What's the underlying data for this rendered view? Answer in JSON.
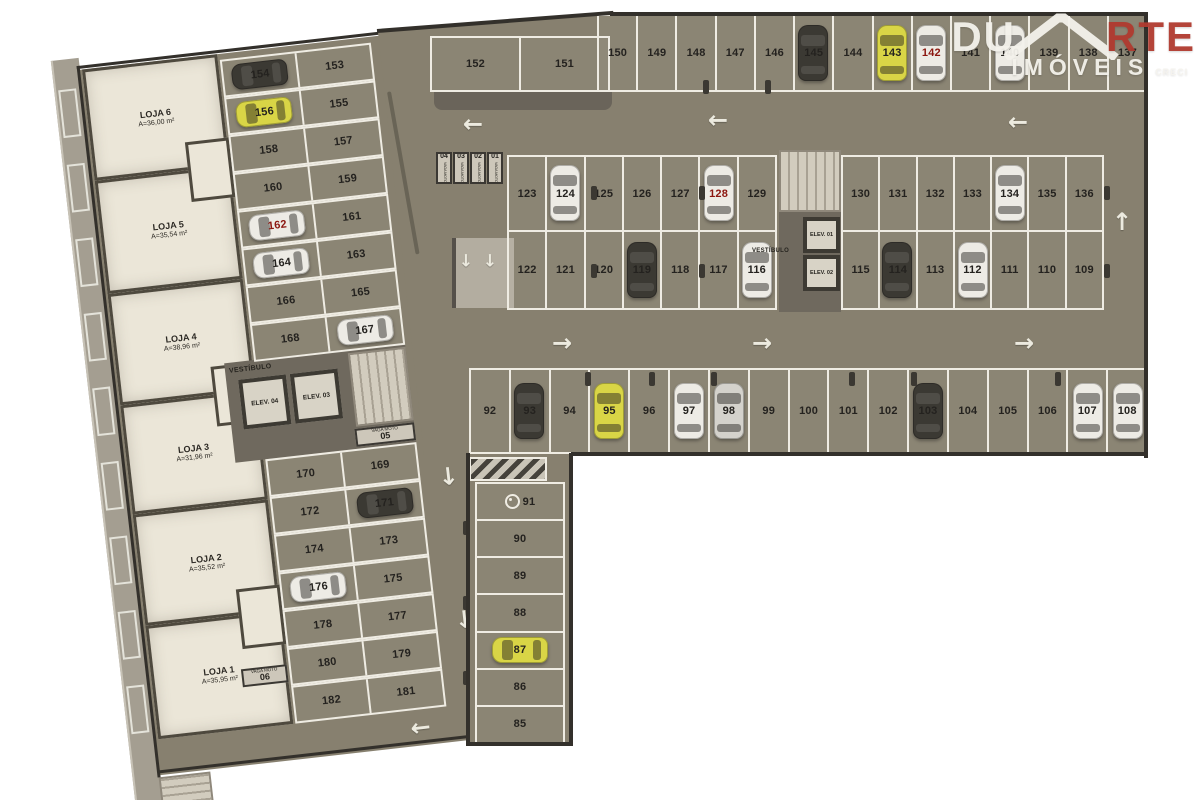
{
  "watermark": {
    "du": "DU",
    "rte": "RTE",
    "imoveis": "IMÓVEIS",
    "creci": "CRECI"
  },
  "colors": {
    "floor": "#87806F",
    "spot_line": "#EFECE3",
    "wall": "#33302B",
    "loja_fill": "#EBE6D8",
    "sidewalk": "#A49E91",
    "ramp": "#B3ADA0",
    "stairs": "#CFC9BB",
    "corridor": "#6F695E",
    "elev_face": "#D8D3C6",
    "accent_red": "#8C1710",
    "logo_red": "#B03A2F",
    "car_dark": "#34312B",
    "car_light": "#EDEBE4",
    "car_yellow": "#D8D43F",
    "car_silver": "#D3D1CA"
  },
  "left_wing": {
    "lojas": [
      {
        "name": "LOJA 6",
        "area": "A=36,00 m²"
      },
      {
        "name": "LOJA 5",
        "area": "A=35,54 m²"
      },
      {
        "name": "LOJA 4",
        "area": "A=38,96 m²"
      },
      {
        "name": "LOJA 3",
        "area": "A=31,96 m²"
      },
      {
        "name": "LOJA 2",
        "area": "A=35,52 m²"
      },
      {
        "name": "LOJA 1",
        "area": "A=35,95 m²"
      }
    ],
    "top_rows": [
      [
        "154",
        "153"
      ],
      [
        "156",
        "155"
      ],
      [
        "158",
        "157"
      ],
      [
        "160",
        "159"
      ],
      [
        "162",
        "161"
      ],
      [
        "164",
        "163"
      ],
      [
        "166",
        "165"
      ],
      [
        "168",
        "167"
      ]
    ],
    "bottom_rows": [
      [
        "170",
        "169"
      ],
      [
        "172",
        "171"
      ],
      [
        "174",
        "173"
      ],
      [
        "176",
        "175"
      ],
      [
        "178",
        "177"
      ],
      [
        "180",
        "179"
      ],
      [
        "182",
        "181"
      ]
    ],
    "vestibule": {
      "label": "VESTÍBULO",
      "elev_a": "ELEV. 04",
      "elev_b": "ELEV. 03"
    },
    "moto_sign_05": {
      "label": "VAGA MOTO",
      "num": "05"
    },
    "moto_sign_06": {
      "label": "VAGA MOTO",
      "num": "06"
    }
  },
  "right_wing": {
    "row_151": [
      "152",
      "151"
    ],
    "row_top": [
      "150",
      "149",
      "148",
      "147",
      "146",
      "145",
      "144",
      "143",
      "142",
      "141",
      "140",
      "139",
      "138",
      "137"
    ],
    "row_mid_up_left": [
      "123",
      "124",
      "125",
      "126",
      "127",
      "128",
      "129"
    ],
    "row_mid_up_right": [
      "130",
      "131",
      "132",
      "133",
      "134",
      "135",
      "136"
    ],
    "row_mid_low_left": [
      "122",
      "121",
      "120",
      "119",
      "118",
      "117",
      "116"
    ],
    "row_mid_low_right": [
      "115",
      "114",
      "113",
      "112",
      "111",
      "110",
      "109"
    ],
    "row_bottom": [
      "92",
      "93",
      "94",
      "95",
      "96",
      "97",
      "98",
      "99",
      "100",
      "101",
      "102",
      "103",
      "104",
      "105",
      "106",
      "107",
      "108"
    ],
    "col_down": [
      "91",
      "90",
      "89",
      "88",
      "87",
      "86",
      "85"
    ],
    "vestibule": {
      "label": "VESTÍBULO",
      "elev_a": "ELEV. 01",
      "elev_b": "ELEV. 02"
    },
    "moto_signs": [
      {
        "label": "VAGA MOTO",
        "num": "04"
      },
      {
        "label": "VAGA MOTO",
        "num": "03"
      },
      {
        "label": "VAGA MOTO",
        "num": "02"
      },
      {
        "label": "VAGA MOTO",
        "num": "01"
      }
    ]
  },
  "red_numbers": [
    "142",
    "128",
    "162"
  ],
  "accessible_spot": "91",
  "cars": [
    {
      "spot": "145",
      "tone": "dark",
      "host": "rw",
      "o": "v",
      "x": 813,
      "y": 53
    },
    {
      "spot": "143",
      "tone": "yellow",
      "host": "rw",
      "o": "v",
      "x": 892,
      "y": 53
    },
    {
      "spot": "142",
      "tone": "light",
      "host": "rw",
      "o": "v",
      "x": 931,
      "y": 53
    },
    {
      "spot": "140",
      "tone": "light",
      "host": "rw",
      "o": "v",
      "x": 1010,
      "y": 53
    },
    {
      "spot": "124",
      "tone": "light",
      "host": "rw",
      "o": "v",
      "x": 565,
      "y": 193
    },
    {
      "spot": "128",
      "tone": "light",
      "host": "rw",
      "o": "v",
      "x": 719,
      "y": 193
    },
    {
      "spot": "134",
      "tone": "light",
      "host": "rw",
      "o": "v",
      "x": 1010,
      "y": 193
    },
    {
      "spot": "119",
      "tone": "dark",
      "host": "rw",
      "o": "v",
      "x": 642,
      "y": 270
    },
    {
      "spot": "116",
      "tone": "light",
      "host": "rw",
      "o": "v",
      "x": 757,
      "y": 270
    },
    {
      "spot": "114",
      "tone": "dark",
      "host": "rw",
      "o": "v",
      "x": 897,
      "y": 270
    },
    {
      "spot": "112",
      "tone": "light",
      "host": "rw",
      "o": "v",
      "x": 973,
      "y": 270
    },
    {
      "spot": "93",
      "tone": "dark",
      "host": "rw",
      "o": "v",
      "x": 529,
      "y": 411
    },
    {
      "spot": "95",
      "tone": "yellow",
      "host": "rw",
      "o": "v",
      "x": 609,
      "y": 411
    },
    {
      "spot": "97",
      "tone": "light",
      "host": "rw",
      "o": "v",
      "x": 689,
      "y": 411
    },
    {
      "spot": "98",
      "tone": "silver",
      "host": "rw",
      "o": "v",
      "x": 729,
      "y": 411
    },
    {
      "spot": "103",
      "tone": "dark",
      "host": "rw",
      "o": "v",
      "x": 928,
      "y": 411
    },
    {
      "spot": "107",
      "tone": "light",
      "host": "rw",
      "o": "v",
      "x": 1088,
      "y": 411
    },
    {
      "spot": "108",
      "tone": "light",
      "host": "rw",
      "o": "v",
      "x": 1128,
      "y": 411
    },
    {
      "spot": "87",
      "tone": "yellow",
      "host": "rw",
      "o": "h",
      "x": 520,
      "y": 650
    },
    {
      "spot": "154",
      "tone": "dark",
      "host": "lw",
      "o": "h",
      "x": 180,
      "y": 25
    },
    {
      "spot": "156",
      "tone": "yellow",
      "host": "lw",
      "o": "h",
      "x": 180,
      "y": 63
    },
    {
      "spot": "162",
      "tone": "light",
      "host": "lw",
      "o": "h",
      "x": 180,
      "y": 177
    },
    {
      "spot": "164",
      "tone": "light",
      "host": "lw",
      "o": "h",
      "x": 180,
      "y": 215
    },
    {
      "spot": "167",
      "tone": "light",
      "host": "lw",
      "o": "h",
      "x": 256,
      "y": 291
    },
    {
      "spot": "171",
      "tone": "dark",
      "host": "lw",
      "o": "h",
      "x": 256,
      "y": 465
    },
    {
      "spot": "176",
      "tone": "light",
      "host": "lw",
      "o": "h",
      "x": 180,
      "y": 541
    }
  ],
  "arrows": [
    {
      "d": "left",
      "host": "rw",
      "x": 473,
      "y": 124,
      "s": 24
    },
    {
      "d": "left",
      "host": "rw",
      "x": 718,
      "y": 120,
      "s": 24
    },
    {
      "d": "left",
      "host": "rw",
      "x": 1018,
      "y": 122,
      "s": 24
    },
    {
      "d": "right",
      "host": "rw",
      "x": 562,
      "y": 343,
      "s": 24
    },
    {
      "d": "right",
      "host": "rw",
      "x": 762,
      "y": 343,
      "s": 24
    },
    {
      "d": "right",
      "host": "rw",
      "x": 1024,
      "y": 343,
      "s": 24
    },
    {
      "d": "up",
      "host": "rw",
      "x": 1122,
      "y": 222,
      "s": 24
    },
    {
      "d": "down",
      "host": "rw",
      "x": 466,
      "y": 262,
      "s": 17
    },
    {
      "d": "down",
      "host": "rw",
      "x": 490,
      "y": 262,
      "s": 17
    },
    {
      "d": "down",
      "host": "lw",
      "x": 324,
      "y": 150,
      "s": 24
    },
    {
      "d": "down",
      "host": "lw",
      "x": 322,
      "y": 446,
      "s": 24
    },
    {
      "d": "down",
      "host": "lw",
      "x": 322,
      "y": 590,
      "s": 24
    },
    {
      "d": "left",
      "host": "lw",
      "x": 266,
      "y": 692,
      "s": 24
    }
  ]
}
